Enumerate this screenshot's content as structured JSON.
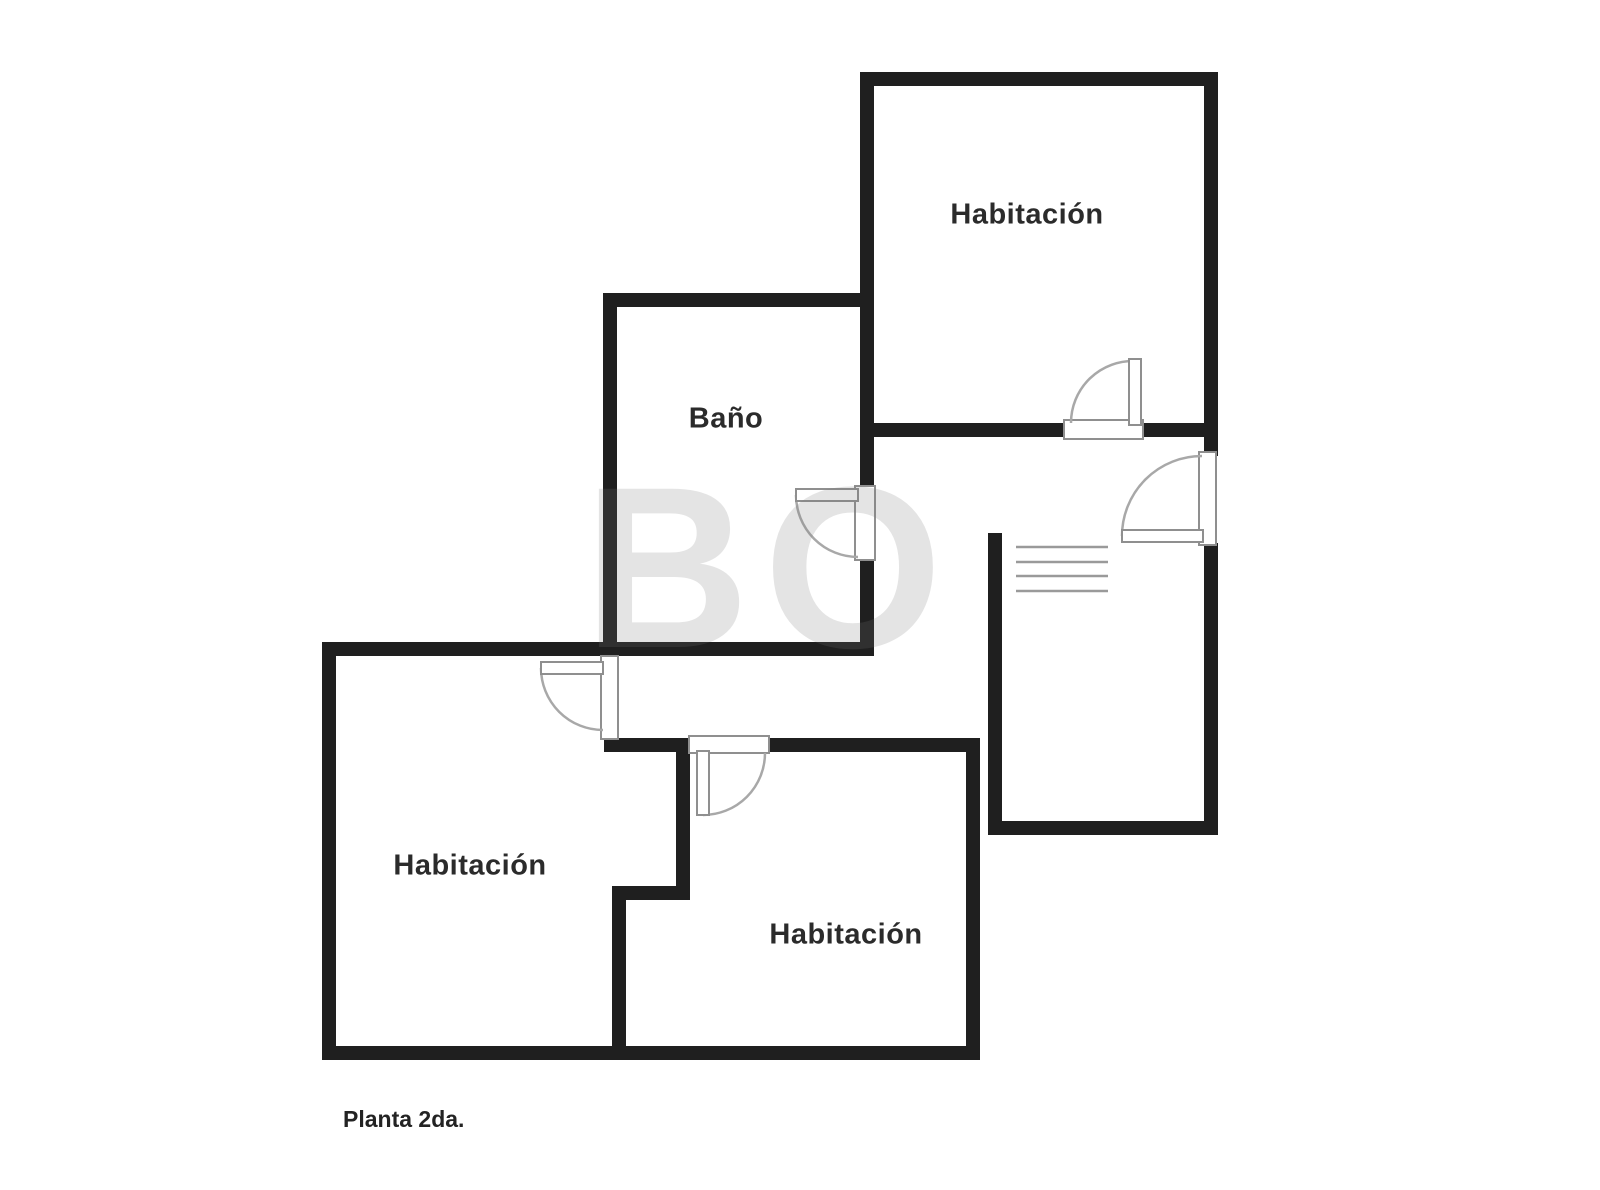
{
  "floor_plan": {
    "title": "Planta 2da.",
    "watermark": "BO",
    "rooms": {
      "bedroom_top": {
        "label": "Habitación"
      },
      "bathroom": {
        "label": "Baño"
      },
      "bedroom_left": {
        "label": "Habitación"
      },
      "bedroom_middle": {
        "label": "Habitación"
      }
    }
  }
}
